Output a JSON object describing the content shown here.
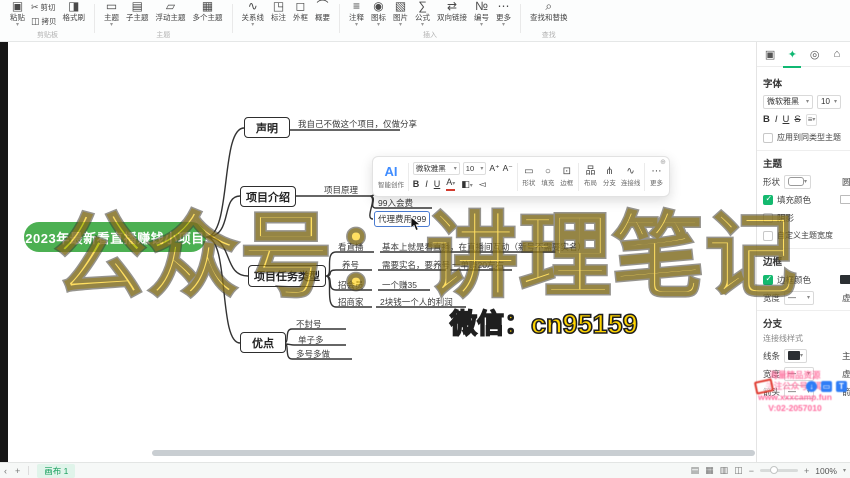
{
  "ribbon": {
    "caret_glyph": "▾",
    "groups": [
      {
        "label": "剪贴板",
        "stacks": [
          [
            {
              "name": "paste-button",
              "icon": "▣",
              "label": "粘贴",
              "caret": true
            }
          ],
          [
            {
              "name": "cut-button",
              "icon": "✂",
              "label": "剪切"
            },
            {
              "name": "copy-button",
              "icon": "◫",
              "label": "拷贝"
            }
          ],
          [
            {
              "name": "format-painter-button",
              "icon": "◨",
              "label": "格式刷"
            }
          ]
        ]
      },
      {
        "label": "主题",
        "stacks": [
          [
            {
              "name": "topic-button",
              "icon": "▭",
              "label": "主题",
              "caret": true
            }
          ],
          [
            {
              "name": "subtopic-button",
              "icon": "▤",
              "label": "子主题"
            }
          ],
          [
            {
              "name": "floating-topic-button",
              "icon": "▱",
              "label": "浮动主题"
            }
          ],
          [
            {
              "name": "multi-topic-button",
              "icon": "▦",
              "label": "多个主题"
            }
          ]
        ]
      },
      {
        "label": "",
        "stacks": [
          [
            {
              "name": "relationship-line-button",
              "icon": "∿",
              "label": "关系线",
              "caret": true
            }
          ],
          [
            {
              "name": "callout-button",
              "icon": "◳",
              "label": "标注"
            }
          ],
          [
            {
              "name": "boundary-button",
              "icon": "◻",
              "label": "外框"
            }
          ],
          [
            {
              "name": "summary-button",
              "icon": "⌒",
              "label": "概要"
            }
          ]
        ]
      },
      {
        "label": "插入",
        "stacks": [
          [
            {
              "name": "note-button",
              "icon": "≡",
              "label": "注释",
              "caret": true
            }
          ],
          [
            {
              "name": "marker-button",
              "icon": "◉",
              "label": "图标",
              "caret": true
            }
          ],
          [
            {
              "name": "image-button",
              "icon": "▧",
              "label": "图片",
              "caret": true
            }
          ],
          [
            {
              "name": "formula-button",
              "icon": "∑",
              "label": "公式",
              "caret": true
            }
          ],
          [
            {
              "name": "bidirectional-link-button",
              "icon": "⇄",
              "label": "双向链接"
            }
          ],
          [
            {
              "name": "numbering-button",
              "icon": "№",
              "label": "编号",
              "caret": true
            }
          ],
          [
            {
              "name": "more-insert-button",
              "icon": "⋯",
              "label": "更多",
              "caret": true
            }
          ]
        ]
      },
      {
        "label": "查找",
        "stacks": [
          [
            {
              "name": "find-replace-button",
              "icon": "⌕",
              "label": "查找和替换"
            }
          ]
        ]
      }
    ]
  },
  "mindmap": {
    "root": "2023年最新看直播赚钱小项目",
    "b1": {
      "label": "声明",
      "child": "我自己不做这个项目，仅做分享"
    },
    "b2": {
      "label": "项目介绍",
      "child": "项目原理",
      "g1": "99入会费",
      "g2": "代理费用299"
    },
    "b3": {
      "label": "项目任务类型",
      "rows": [
        {
          "t": "看直播",
          "d": "基本上就是看直播，在直播间互动（新号不需要实名）"
        },
        {
          "t": "养号",
          "d": "需要实名，要养号",
          "e": "一单赚20左右"
        },
        {
          "t": "招会员",
          "d": "一个赚35"
        },
        {
          "t": "招商家",
          "d": "2块钱一个人的利润"
        }
      ]
    },
    "b4": {
      "label": "优点",
      "rows": [
        "不封号",
        "单子多",
        "多号多做"
      ]
    }
  },
  "floating_toolbar": {
    "ai_text": "AI",
    "ai_label": "智能创作",
    "font_family": "微软雅黑",
    "font_size": "10",
    "grow": "A⁺",
    "shrink": "A⁻",
    "bold": "B",
    "italic": "I",
    "underline": "U",
    "font_color": "A",
    "highlight_icon": "◧",
    "painter_icon": "◅",
    "items": [
      {
        "name": "shape-button",
        "icon": "▭",
        "label": "形状"
      },
      {
        "name": "fill-button",
        "icon": "○",
        "label": "填充"
      },
      {
        "name": "border-button",
        "icon": "⊡",
        "label": "边框"
      },
      {
        "name": "layout-button",
        "icon": "品",
        "label": "布局"
      },
      {
        "name": "branch-button",
        "icon": "⋔",
        "label": "分支"
      },
      {
        "name": "connector-button",
        "icon": "∿",
        "label": "连接线"
      },
      {
        "name": "more-button",
        "icon": "⋯",
        "label": "更多"
      }
    ]
  },
  "sidebar": {
    "tabs": [
      {
        "name": "canvas-tab",
        "icon": "▣"
      },
      {
        "name": "style-tab",
        "icon": "✦"
      },
      {
        "name": "theme-tab",
        "icon": "◎"
      },
      {
        "name": "structure-tab",
        "icon": "⌂"
      }
    ],
    "font_section": {
      "title": "字体",
      "family": "微软雅黑",
      "size": "10",
      "bold": "B",
      "italic": "I",
      "underline": "U",
      "strike": "S",
      "align_icon": "≡",
      "apply_label": "应用到同类型主题"
    },
    "theme_section": {
      "title": "主题",
      "shape_label": "形状",
      "corner_label": "圆角",
      "fill_label": "填充颜色",
      "shadow_label": "阴影",
      "custom_width_label": "自定义主题宽度"
    },
    "border_section": {
      "title": "边框",
      "color_label": "边框颜色",
      "width_label": "宽度",
      "dash_label": "虚线"
    },
    "branch_section": {
      "title": "分支",
      "style_label": "连接线样式",
      "line_label": "线条",
      "trunk_label": "主题",
      "width_label": "宽度",
      "dash_label": "虚线",
      "arrow_label": "箭头",
      "end_label": "箭头"
    }
  },
  "statusbar": {
    "collapse": "‹",
    "add": "+",
    "tab": "画布 1",
    "view_icons": [
      "▤",
      "▦",
      "▥",
      "◫"
    ],
    "minus": "−",
    "plus": "+",
    "zoom": "100%",
    "caret": "▾"
  },
  "watermarks": {
    "big": "公众号：讲理笔记",
    "wechat": "微信：cn95159",
    "pink_lines": [
      "海量精品资源",
      "关注公众号领取",
      "www.xxxcamp.fun",
      "V:02-2057010"
    ]
  }
}
